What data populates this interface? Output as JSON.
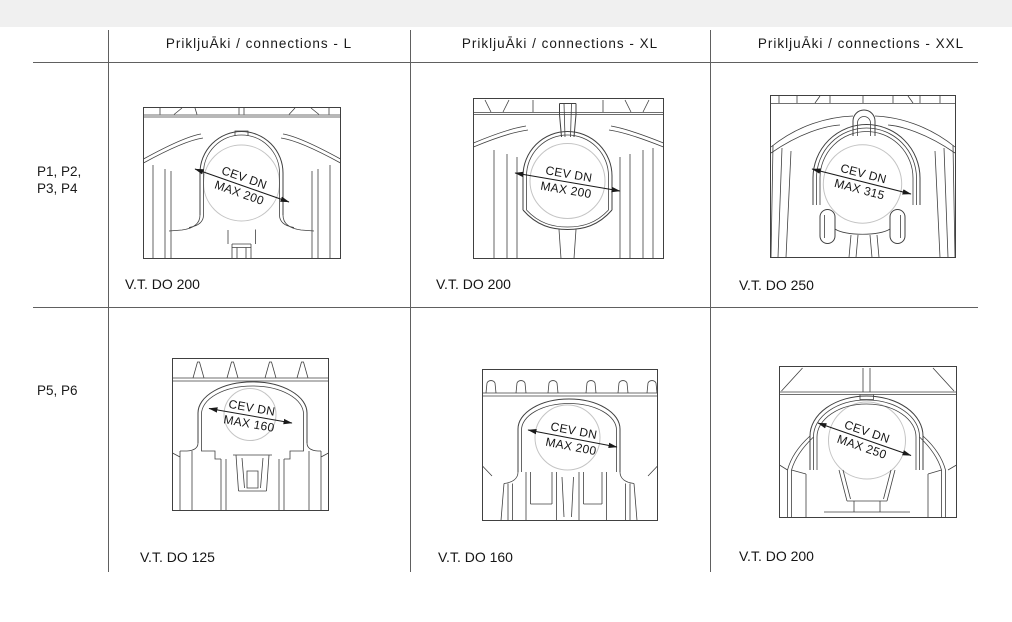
{
  "page": {
    "title": "Connections table",
    "colors": {
      "top_bar": "#f0f0f0",
      "background": "#ffffff",
      "grid_line": "#606060",
      "drawing_line": "#404040",
      "circle_line": "#c4c4c4",
      "text": "#1a1a1a"
    }
  },
  "table": {
    "column_headers": [
      "PrikljuĀki / connections - L",
      "PrikljuĀki / connections - XL",
      "PrikljuĀki / connections - XXL"
    ],
    "rows": [
      {
        "label_lines": [
          "P1, P2,",
          "P3, P4"
        ],
        "cells": [
          {
            "dim_line1": "CEV DN",
            "dim_line2": "MAX 200",
            "caption": "V.T. DO 200"
          },
          {
            "dim_line1": "CEV DN",
            "dim_line2": "MAX 200",
            "caption": "V.T. DO 200"
          },
          {
            "dim_line1": "CEV DN",
            "dim_line2": "MAX 315",
            "caption": "V.T. DO 250"
          }
        ]
      },
      {
        "label_lines": [
          "P5, P6"
        ],
        "cells": [
          {
            "dim_line1": "CEV DN",
            "dim_line2": "MAX 160",
            "caption": "V.T. DO 125"
          },
          {
            "dim_line1": "CEV DN",
            "dim_line2": "MAX 200",
            "caption": "V.T. DO 160"
          },
          {
            "dim_line1": "CEV DN",
            "dim_line2": "MAX 250",
            "caption": "V.T. DO 200"
          }
        ]
      }
    ]
  }
}
